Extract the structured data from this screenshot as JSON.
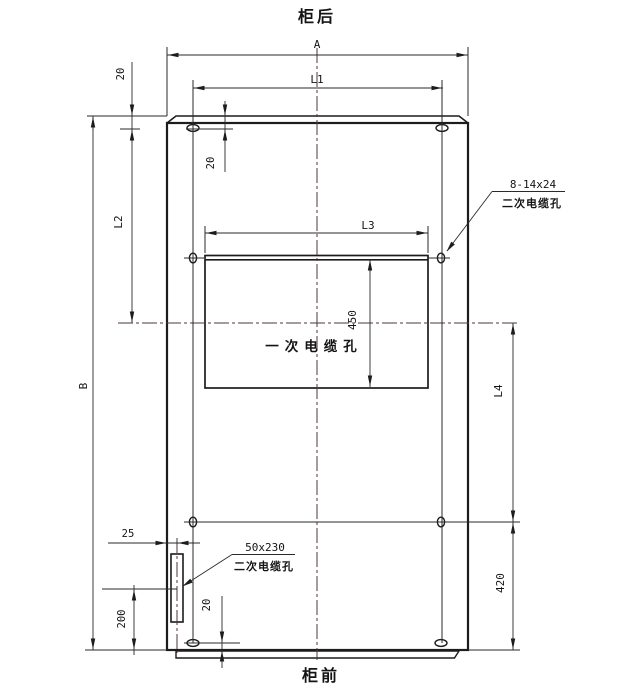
{
  "titles": {
    "top": "柜后",
    "bottom": "柜前"
  },
  "dims": {
    "A": "A",
    "B": "B",
    "L1": "L1",
    "L2": "L2",
    "L3": "L3",
    "L4": "L4",
    "d450": "450",
    "d420": "420",
    "d200": "200",
    "d25": "25",
    "d20_top_left": "20",
    "d20_top_inner": "20",
    "d20_bottom": "20"
  },
  "callouts": {
    "secondary_top": {
      "size": "8-14x24",
      "label": "二次电缆孔"
    },
    "secondary_bottom": {
      "size": "50x230",
      "label": "二次电缆孔"
    },
    "primary": {
      "label": "一次电缆孔"
    }
  },
  "colors": {
    "line": "#1c1c1c",
    "centerline": "#4a3838",
    "background": "#ffffff"
  }
}
